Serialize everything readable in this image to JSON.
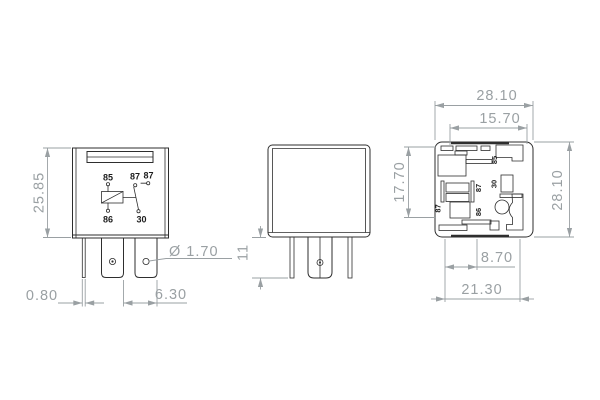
{
  "colors": {
    "line": "#2e2e2e",
    "dim": "#9aa0a3",
    "label": "#1c1c1c",
    "bg": "#ffffff"
  },
  "front_view": {
    "dims": {
      "height": "25.85",
      "pin_width": "0.80",
      "pin_spacing": "6.30",
      "hole_diameter": "Ø 1.70"
    },
    "circuit": {
      "pin_85": "85",
      "pin_86": "86",
      "pin_87_left": "87",
      "pin_87_right": "87",
      "pin_30": "30"
    }
  },
  "side_view": {
    "dims": {
      "pin_length": "11"
    }
  },
  "bottom_view": {
    "dims": {
      "overall_width": "28.10",
      "inner_width": "15.70",
      "inner_height": "17.70",
      "overall_height": "28.10",
      "pin_offset": "8.70",
      "base_width": "21.30"
    },
    "pins": {
      "pin_85": "85",
      "pin_30": "30",
      "pin_87_center": "87",
      "pin_87_outer": "87",
      "pin_86": "86"
    }
  }
}
